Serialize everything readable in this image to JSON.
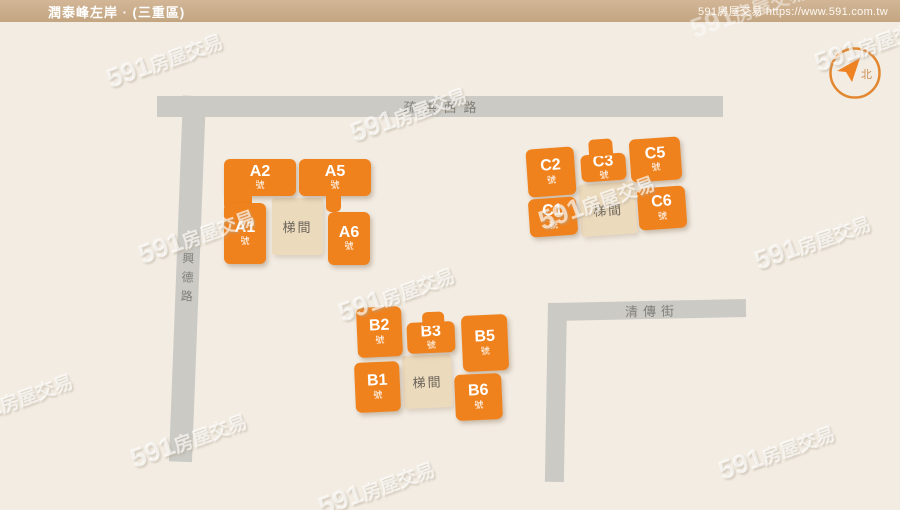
{
  "header": {
    "title": "潤泰峰左岸 · (三重區)",
    "brand": "591房屋交易",
    "url": "https://www.591.com.tw",
    "brand_line": "591房屋交易 https://www.591.com.tw"
  },
  "roads": {
    "top": {
      "name": "疏洪西路"
    },
    "left": {
      "name": "興德路"
    },
    "right": {
      "name": "清傳街"
    }
  },
  "compass": {
    "north": "北"
  },
  "clusters": {
    "A": {
      "stairwell": "梯間",
      "buildings": {
        "a1": {
          "name": "A1",
          "unit": "號"
        },
        "a2": {
          "name": "A2",
          "unit": "號"
        },
        "a5": {
          "name": "A5",
          "unit": "號"
        },
        "a6": {
          "name": "A6",
          "unit": "號"
        }
      }
    },
    "B": {
      "stairwell": "梯間",
      "buildings": {
        "b1": {
          "name": "B1",
          "unit": "號"
        },
        "b2": {
          "name": "B2",
          "unit": "號"
        },
        "b3": {
          "name": "B3",
          "unit": "號"
        },
        "b5": {
          "name": "B5",
          "unit": "號"
        },
        "b6": {
          "name": "B6",
          "unit": "號"
        }
      }
    },
    "C": {
      "stairwell": "梯間",
      "buildings": {
        "c1": {
          "name": "C1",
          "unit": "號"
        },
        "c2": {
          "name": "C2",
          "unit": "號"
        },
        "c3": {
          "name": "C3",
          "unit": "號"
        },
        "c5": {
          "name": "C5",
          "unit": "號"
        },
        "c6": {
          "name": "C6",
          "unit": "號"
        }
      }
    }
  },
  "watermark": {
    "num": "591",
    "cjk": "房屋交易"
  },
  "colors": {
    "building": "#F0821D",
    "stairwell": "#ECDABD",
    "road": "#CBCAC5",
    "header_bar": "#CBAE8E",
    "accent": "#EF8222",
    "background": "#F2ECE3"
  }
}
